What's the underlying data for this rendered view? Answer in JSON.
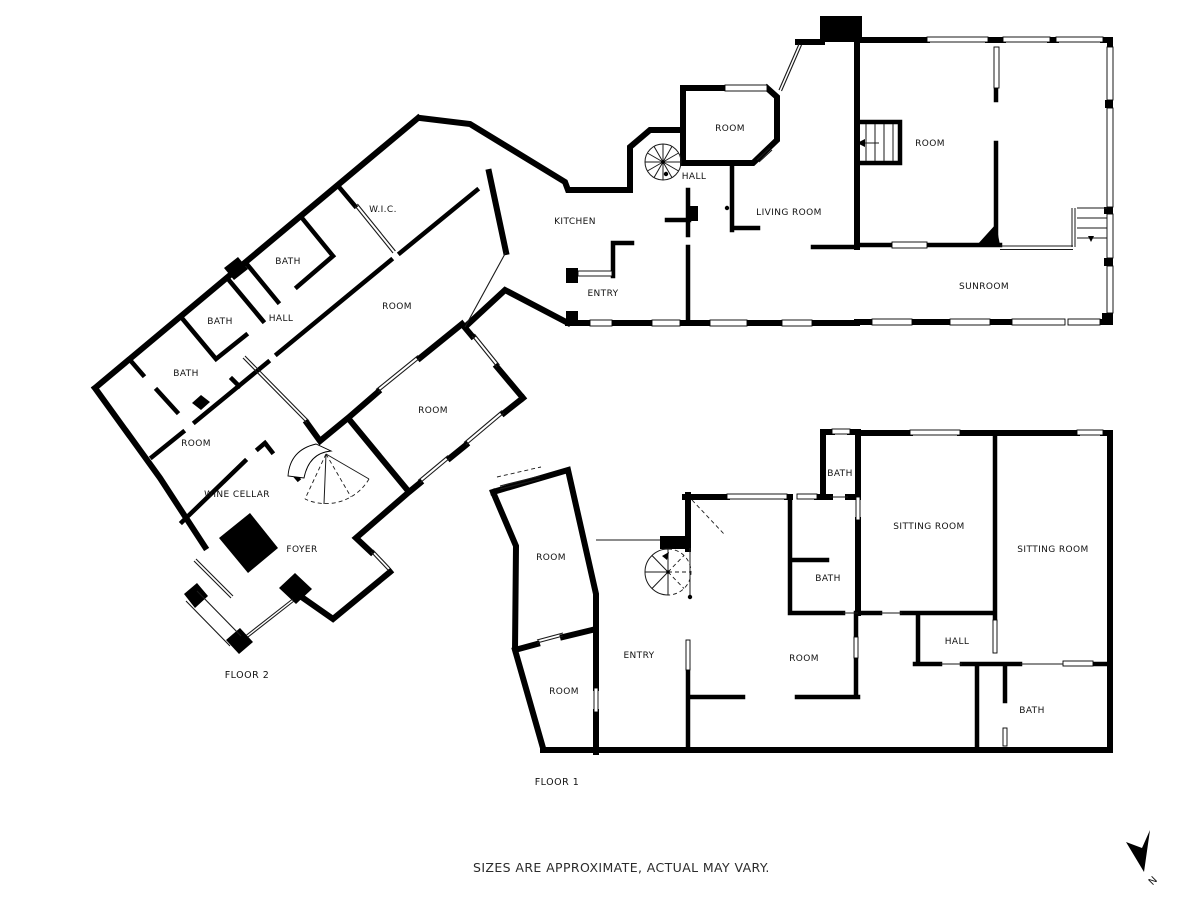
{
  "floor2": {
    "label": "FLOOR 2",
    "rooms": [
      {
        "name": "W.I.C."
      },
      {
        "name": "BATH"
      },
      {
        "name": "BATH"
      },
      {
        "name": "HALL"
      },
      {
        "name": "BATH"
      },
      {
        "name": "ROOM"
      },
      {
        "name": "ROOM"
      },
      {
        "name": "WINE CELLAR"
      },
      {
        "name": "FOYER"
      },
      {
        "name": "ROOM"
      },
      {
        "name": "KITCHEN"
      },
      {
        "name": "ENTRY"
      },
      {
        "name": "HALL"
      },
      {
        "name": "ROOM"
      },
      {
        "name": "LIVING ROOM"
      },
      {
        "name": "ROOM"
      },
      {
        "name": "SUNROOM"
      }
    ]
  },
  "floor1": {
    "label": "FLOOR 1",
    "rooms": [
      {
        "name": "ROOM"
      },
      {
        "name": "ROOM"
      },
      {
        "name": "ENTRY"
      },
      {
        "name": "ROOM"
      },
      {
        "name": "BATH"
      },
      {
        "name": "BATH"
      },
      {
        "name": "SITTING ROOM"
      },
      {
        "name": "SITTING ROOM"
      },
      {
        "name": "HALL"
      },
      {
        "name": "BATH"
      }
    ]
  },
  "footer": {
    "disclaimer": "SIZES ARE APPROXIMATE, ACTUAL MAY VARY."
  },
  "compass": {
    "label": "N"
  }
}
